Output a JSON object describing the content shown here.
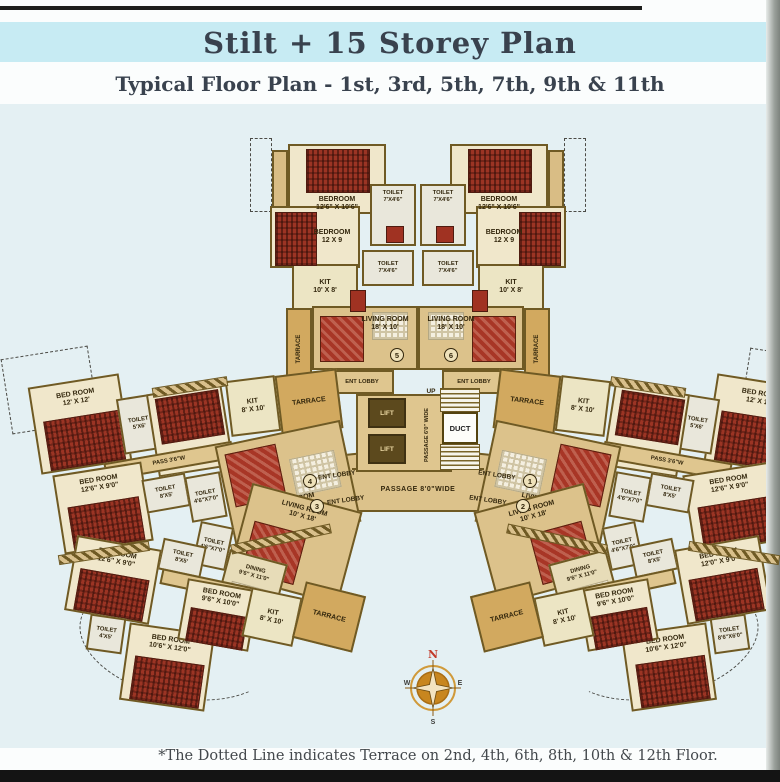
{
  "header": {
    "title": "Stilt + 15 Storey Plan",
    "subtitle": "Typical Floor Plan - 1st, 3rd, 5th, 7th, 9th & 11th"
  },
  "footer": {
    "note": "*The Dotted Line indicates Terrace on 2nd, 4th, 6th, 8th, 10th & 12th Floor."
  },
  "compass": {
    "n": "N",
    "e": "E",
    "s": "S",
    "w": "W"
  },
  "colors": {
    "title_band": "#c7ebf3",
    "wall_brown": "#6f5a24",
    "floor_tan": "#dcc28b",
    "bed_red": "#9b3424",
    "plan_background": "#e4f0f3"
  },
  "core": {
    "up": "UP",
    "lift": "LIFT",
    "duct": "DUCT",
    "passage_vertical": "PASSAGE 6'0\" WIDE",
    "passage_arc": "PASSAGE 8'0\"WIDE",
    "ent_lobby": "ENT LOBBY",
    "unit1": "1",
    "unit2": "2",
    "unit3": "3",
    "unit4": "4",
    "unit5": "5",
    "unit6": "6"
  },
  "top_unit": {
    "bedroom1": "BEDROOM\n12'6\" X 10'6\"",
    "bedroom2": "BEDROOM\n12 X 9",
    "toilet": "TOILET\n7'X4'6\"",
    "kit": "KIT\n10' X 8'",
    "living": "LIVING ROOM\n18' X 10'",
    "terrace": "TARRACE",
    "ent_lobby": "ENT LOBBY"
  },
  "wing_upper_flat": {
    "bedroom_a": "BED ROOM\n12' X 12'",
    "toilet_top": "TOILET\n5'X6'",
    "bedroom_b": "BED ROOM\n9'6\" X 12'0\"",
    "kit": "KIT\n8' X 10'",
    "terrace": "TARRACE",
    "pass": "PASS 3'6\"W",
    "bedroom_c": "BED ROOM\n12'6\" X 9'0\"",
    "toilet_1": "TOILET\n8'X5'",
    "toilet_2": "TOILET\n4'6\"X7'0\"",
    "living": "LIVING ROOM\n18'6\" X 15'0\""
  },
  "wing_lower_flat": {
    "living": "LIVING ROOM\n10' X 18'",
    "dining": "DINING\n9'6\" X 11'0\"",
    "pass": "PASS 3'6\"W",
    "bedroom_a": "BED ROOM\n12'6\" X 9'0\"",
    "toilet_1": "TOILET\n8'X5'",
    "toilet_2": "TOILET\n4'6\"X7'0\"",
    "bedroom_b": "BED ROOM\n9'6\" X 10'0\"",
    "kit": "KIT\n8' X 10'",
    "bedroom_c": "BED ROOM\n10'6\" X 12'0\"",
    "toilet_bottom": "TOILET\n4'X5'",
    "terrace": "TARRACE"
  },
  "wing_lower_flat_right": {
    "bedroom_a": "BED ROOM\n12'0\" X 9'0\"",
    "toilet_bottom": "TOILET\n8'6\"X6'0\""
  }
}
